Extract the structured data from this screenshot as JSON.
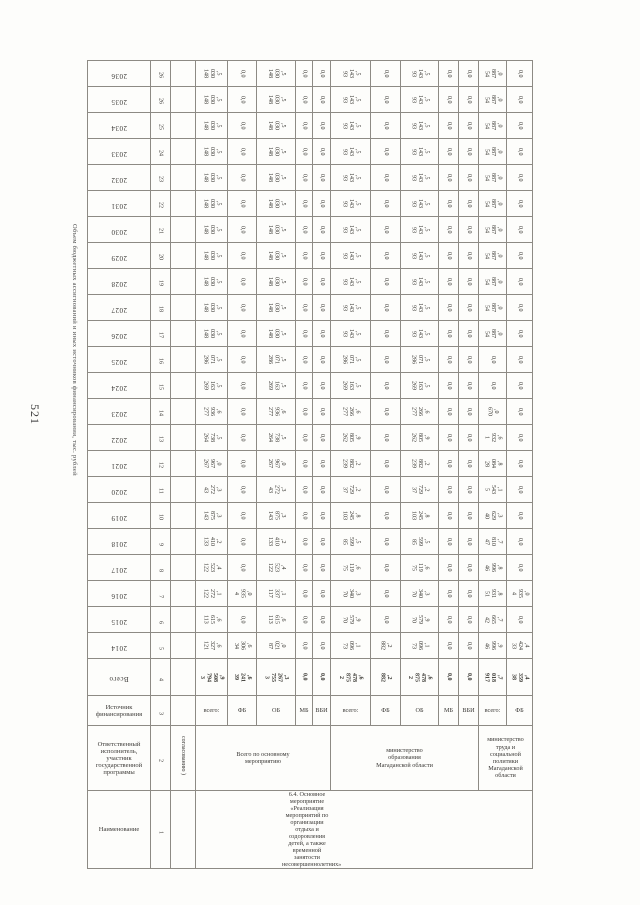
{
  "page": {
    "number": "521"
  },
  "table_title_side": "Объем бюджетных ассигнований и иных источников финансирования, тыс. рублей",
  "header": {
    "col1": "Наименование",
    "col2": "Ответственный исполнитель, участник государственной программы",
    "col3": "Источник финансирования",
    "col4": "Всего",
    "col_numbers": [
      "1",
      "2",
      "3",
      "4"
    ],
    "continuation_note": "согласованию )"
  },
  "row_name": "6.4. Основное мероприятие «Реализация мероприятий по организации отдыха и оздоровления детей, а также временной занятости несовершеннолетних»",
  "groups": [
    {
      "executor": "Всего по основному мероприятию",
      "sources": [
        "всего:",
        "ФБ",
        "ОБ",
        "МБ",
        "ВБИ"
      ],
      "totals": [
        "3 794 508,9",
        "39 241,6",
        "3 755 267,3",
        "0,0",
        "0,0"
      ]
    },
    {
      "executor": "министерство образования Магаданской области",
      "sources": [
        "всего:",
        "ФБ",
        "ОБ",
        "МБ",
        "ВБИ"
      ],
      "totals": [
        "2 875 478,6",
        "882,2",
        "2 875 478,6",
        "0,0",
        "0,0"
      ]
    },
    {
      "executor": "министерство труда и социальной политики Магаданской области",
      "sources": [
        "всего:",
        "ФБ"
      ],
      "totals": [
        "917 018,7",
        "38 359,4"
      ]
    }
  ],
  "years": [
    {
      "year": "2036",
      "num": "26",
      "values": [
        "148 030,5",
        "0,0",
        "148 030,5",
        "0,0",
        "0,0",
        "93 143,5",
        "0,0",
        "93 143,5",
        "0,0",
        "0,0",
        "54 887,0",
        "0,0"
      ]
    },
    {
      "year": "2035",
      "num": "26",
      "values": [
        "148 030,5",
        "0,0",
        "148 030,5",
        "0,0",
        "0,0",
        "93 143,5",
        "0,0",
        "93 143,5",
        "0,0",
        "0,0",
        "54 887,0",
        "0,0"
      ]
    },
    {
      "year": "2034",
      "num": "25",
      "values": [
        "148 030,5",
        "0,0",
        "148 030,5",
        "0,0",
        "0,0",
        "93 143,5",
        "0,0",
        "93 143,5",
        "0,0",
        "0,0",
        "54 887,0",
        "0,0"
      ]
    },
    {
      "year": "2033",
      "num": "24",
      "values": [
        "148 030,5",
        "0,0",
        "148 030,5",
        "0,0",
        "0,0",
        "93 143,5",
        "0,0",
        "93 143,5",
        "0,0",
        "0,0",
        "54 887,0",
        "0,0"
      ]
    },
    {
      "year": "2032",
      "num": "23",
      "values": [
        "148 030,5",
        "0,0",
        "148 030,5",
        "0,0",
        "0,0",
        "93 143,5",
        "0,0",
        "93 143,5",
        "0,0",
        "0,0",
        "54 887,0",
        "0,0"
      ]
    },
    {
      "year": "2031",
      "num": "22",
      "values": [
        "148 030,5",
        "0,0",
        "148 030,5",
        "0,0",
        "0,0",
        "93 143,5",
        "0,0",
        "93 143,5",
        "0,0",
        "0,0",
        "54 887,0",
        "0,0"
      ]
    },
    {
      "year": "2030",
      "num": "21",
      "values": [
        "148 030,5",
        "0,0",
        "148 030,5",
        "0,0",
        "0,0",
        "93 143,5",
        "0,0",
        "93 143,5",
        "0,0",
        "0,0",
        "54 887,0",
        "0,0"
      ]
    },
    {
      "year": "2029",
      "num": "20",
      "values": [
        "148 030,5",
        "0,0",
        "148 030,5",
        "0,0",
        "0,0",
        "93 143,5",
        "0,0",
        "93 143,5",
        "0,0",
        "0,0",
        "54 887,0",
        "0,0"
      ]
    },
    {
      "year": "2028",
      "num": "19",
      "values": [
        "148 030,5",
        "0,0",
        "148 030,5",
        "0,0",
        "0,0",
        "93 143,5",
        "0,0",
        "93 143,5",
        "0,0",
        "0,0",
        "54 887,0",
        "0,0"
      ]
    },
    {
      "year": "2027",
      "num": "18",
      "values": [
        "148 030,5",
        "0,0",
        "148 030,5",
        "0,0",
        "0,0",
        "93 143,5",
        "0,0",
        "93 143,5",
        "0,0",
        "0,0",
        "54 887,0",
        "0,0"
      ]
    },
    {
      "year": "2026",
      "num": "17",
      "values": [
        "148 030,5",
        "0,0",
        "148 030,5",
        "0,0",
        "0,0",
        "93 143,5",
        "0,0",
        "93 143,5",
        "0,0",
        "0,0",
        "54 887,0",
        "0,0"
      ]
    },
    {
      "year": "2025",
      "num": "16",
      "values": [
        "286 071,5",
        "0,0",
        "286 071,5",
        "0,0",
        "0,0",
        "286 071,5",
        "0,0",
        "286 071,5",
        "0,0",
        "0,0",
        "0,0",
        "0,0"
      ]
    },
    {
      "year": "2024",
      "num": "15",
      "values": [
        "269 163,5",
        "0,0",
        "269 163,5",
        "0,0",
        "0,0",
        "269 163,5",
        "0,0",
        "269 163,5",
        "0,0",
        "0,0",
        "0,0",
        "0,0"
      ]
    },
    {
      "year": "2023",
      "num": "14",
      "values": [
        "277 936,6",
        "0,0",
        "277 936,6",
        "0,0",
        "0,0",
        "277 266,6",
        "0,0",
        "277 266,6",
        "0,0",
        "0,0",
        "670,0",
        "0,0"
      ]
    },
    {
      "year": "2022",
      "num": "13",
      "values": [
        "264 738,5",
        "0,0",
        "264 738,5",
        "0,0",
        "0,0",
        "262 805,9",
        "0,0",
        "262 805,9",
        "0,0",
        "0,0",
        "1 932,6",
        "0,0"
      ]
    },
    {
      "year": "2021",
      "num": "12",
      "values": [
        "267 967,0",
        "0,0",
        "267 967,0",
        "0,0",
        "0,0",
        "239 882,2",
        "0,0",
        "239 882,2",
        "0,0",
        "0,0",
        "28 084,8",
        "0,0"
      ]
    },
    {
      "year": "2020",
      "num": "11",
      "values": [
        "43 272,3",
        "0,0",
        "43 272,3",
        "0,0",
        "0,0",
        "37 729,2",
        "0,0",
        "37 729,2",
        "0,0",
        "0,0",
        "5 543,1",
        "0,0"
      ]
    },
    {
      "year": "2019",
      "num": "10",
      "values": [
        "143 875,3",
        "0,0",
        "143 875,3",
        "0,0",
        "0,0",
        "103 245,8",
        "0,0",
        "103 245,8",
        "0,0",
        "0,0",
        "40 629,3",
        "0,0"
      ]
    },
    {
      "year": "2018",
      "num": "9",
      "values": [
        "133 410,2",
        "0,0",
        "133 410,2",
        "0,0",
        "0,0",
        "85 599,5",
        "0,0",
        "85 599,5",
        "0,0",
        "0,0",
        "47 810,7",
        "0,0"
      ]
    },
    {
      "year": "2017",
      "num": "8",
      "values": [
        "122 523,4",
        "0,0",
        "122 523,4",
        "0,0",
        "0,0",
        "75 119,6",
        "0,0",
        "75 119,6",
        "0,0",
        "0,0",
        "46 996,8",
        "0,0"
      ]
    },
    {
      "year": "2016",
      "num": "7",
      "values": [
        "122 272,1",
        "4 935,0",
        "117 337,1",
        "0,0",
        "0,0",
        "70 340,3",
        "0,0",
        "70 340,3",
        "0,0",
        "0,0",
        "51 931,8",
        "4 935,0"
      ]
    },
    {
      "year": "2015",
      "num": "6",
      "values": [
        "113 615,6",
        "0,0",
        "113 615,6",
        "0,0",
        "0,0",
        "70 579,9",
        "0,0",
        "70 579,9",
        "0,0",
        "0,0",
        "42 665,7",
        "0,0"
      ]
    },
    {
      "year": "2014",
      "num": "5",
      "values": [
        "121 327,6",
        "34 306,6",
        "87 021,0",
        "0,0",
        "0,0",
        "73 096,1",
        "882,2",
        "73 096,1",
        "0,0",
        "0,0",
        "46 996,9",
        "33 424,4"
      ]
    }
  ]
}
